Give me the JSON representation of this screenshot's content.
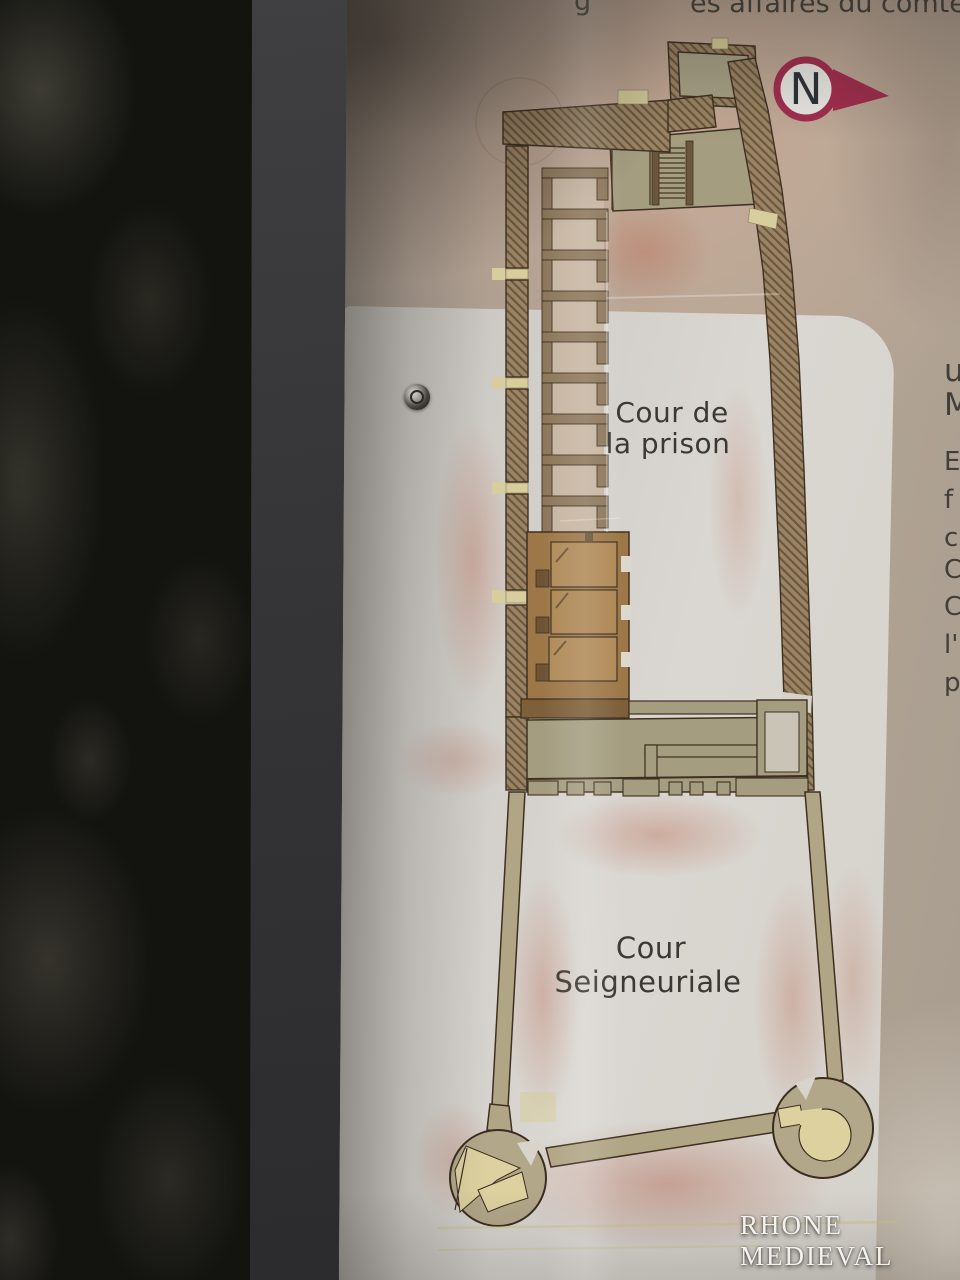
{
  "sign": {
    "header": {
      "fragment_g": "g",
      "fragment_right": "es affaires du comte"
    },
    "north_arrow": {
      "label": "N"
    },
    "plan": {
      "prison_court": {
        "line1": "Cour de",
        "line2": "la prison"
      },
      "seigneurial_court": {
        "line1": "Cour",
        "line2": "Seigneuriale"
      }
    },
    "right_text_fragments": [
      "u",
      "M",
      "E",
      "f",
      "c",
      "C",
      "C",
      "l'",
      "p"
    ],
    "watermark": "RHONE MEDIEVAL",
    "colors": {
      "north_arrow_red": "#a22e4e",
      "wall_hatch_brown": "#9a8465",
      "wall_outline": "#3f3020",
      "room_olive": "#a49d80",
      "highlight_room_brown": "#a87f52",
      "tower_fill": "#b3a78a",
      "tower_interior_yellow": "#ddd1a0",
      "door_gap_yellow": "#d8cd9c",
      "panel_pink": "#c6b0a1",
      "card_white": "#d9d6d1",
      "airbrush_salmon": "#bc7862"
    }
  }
}
